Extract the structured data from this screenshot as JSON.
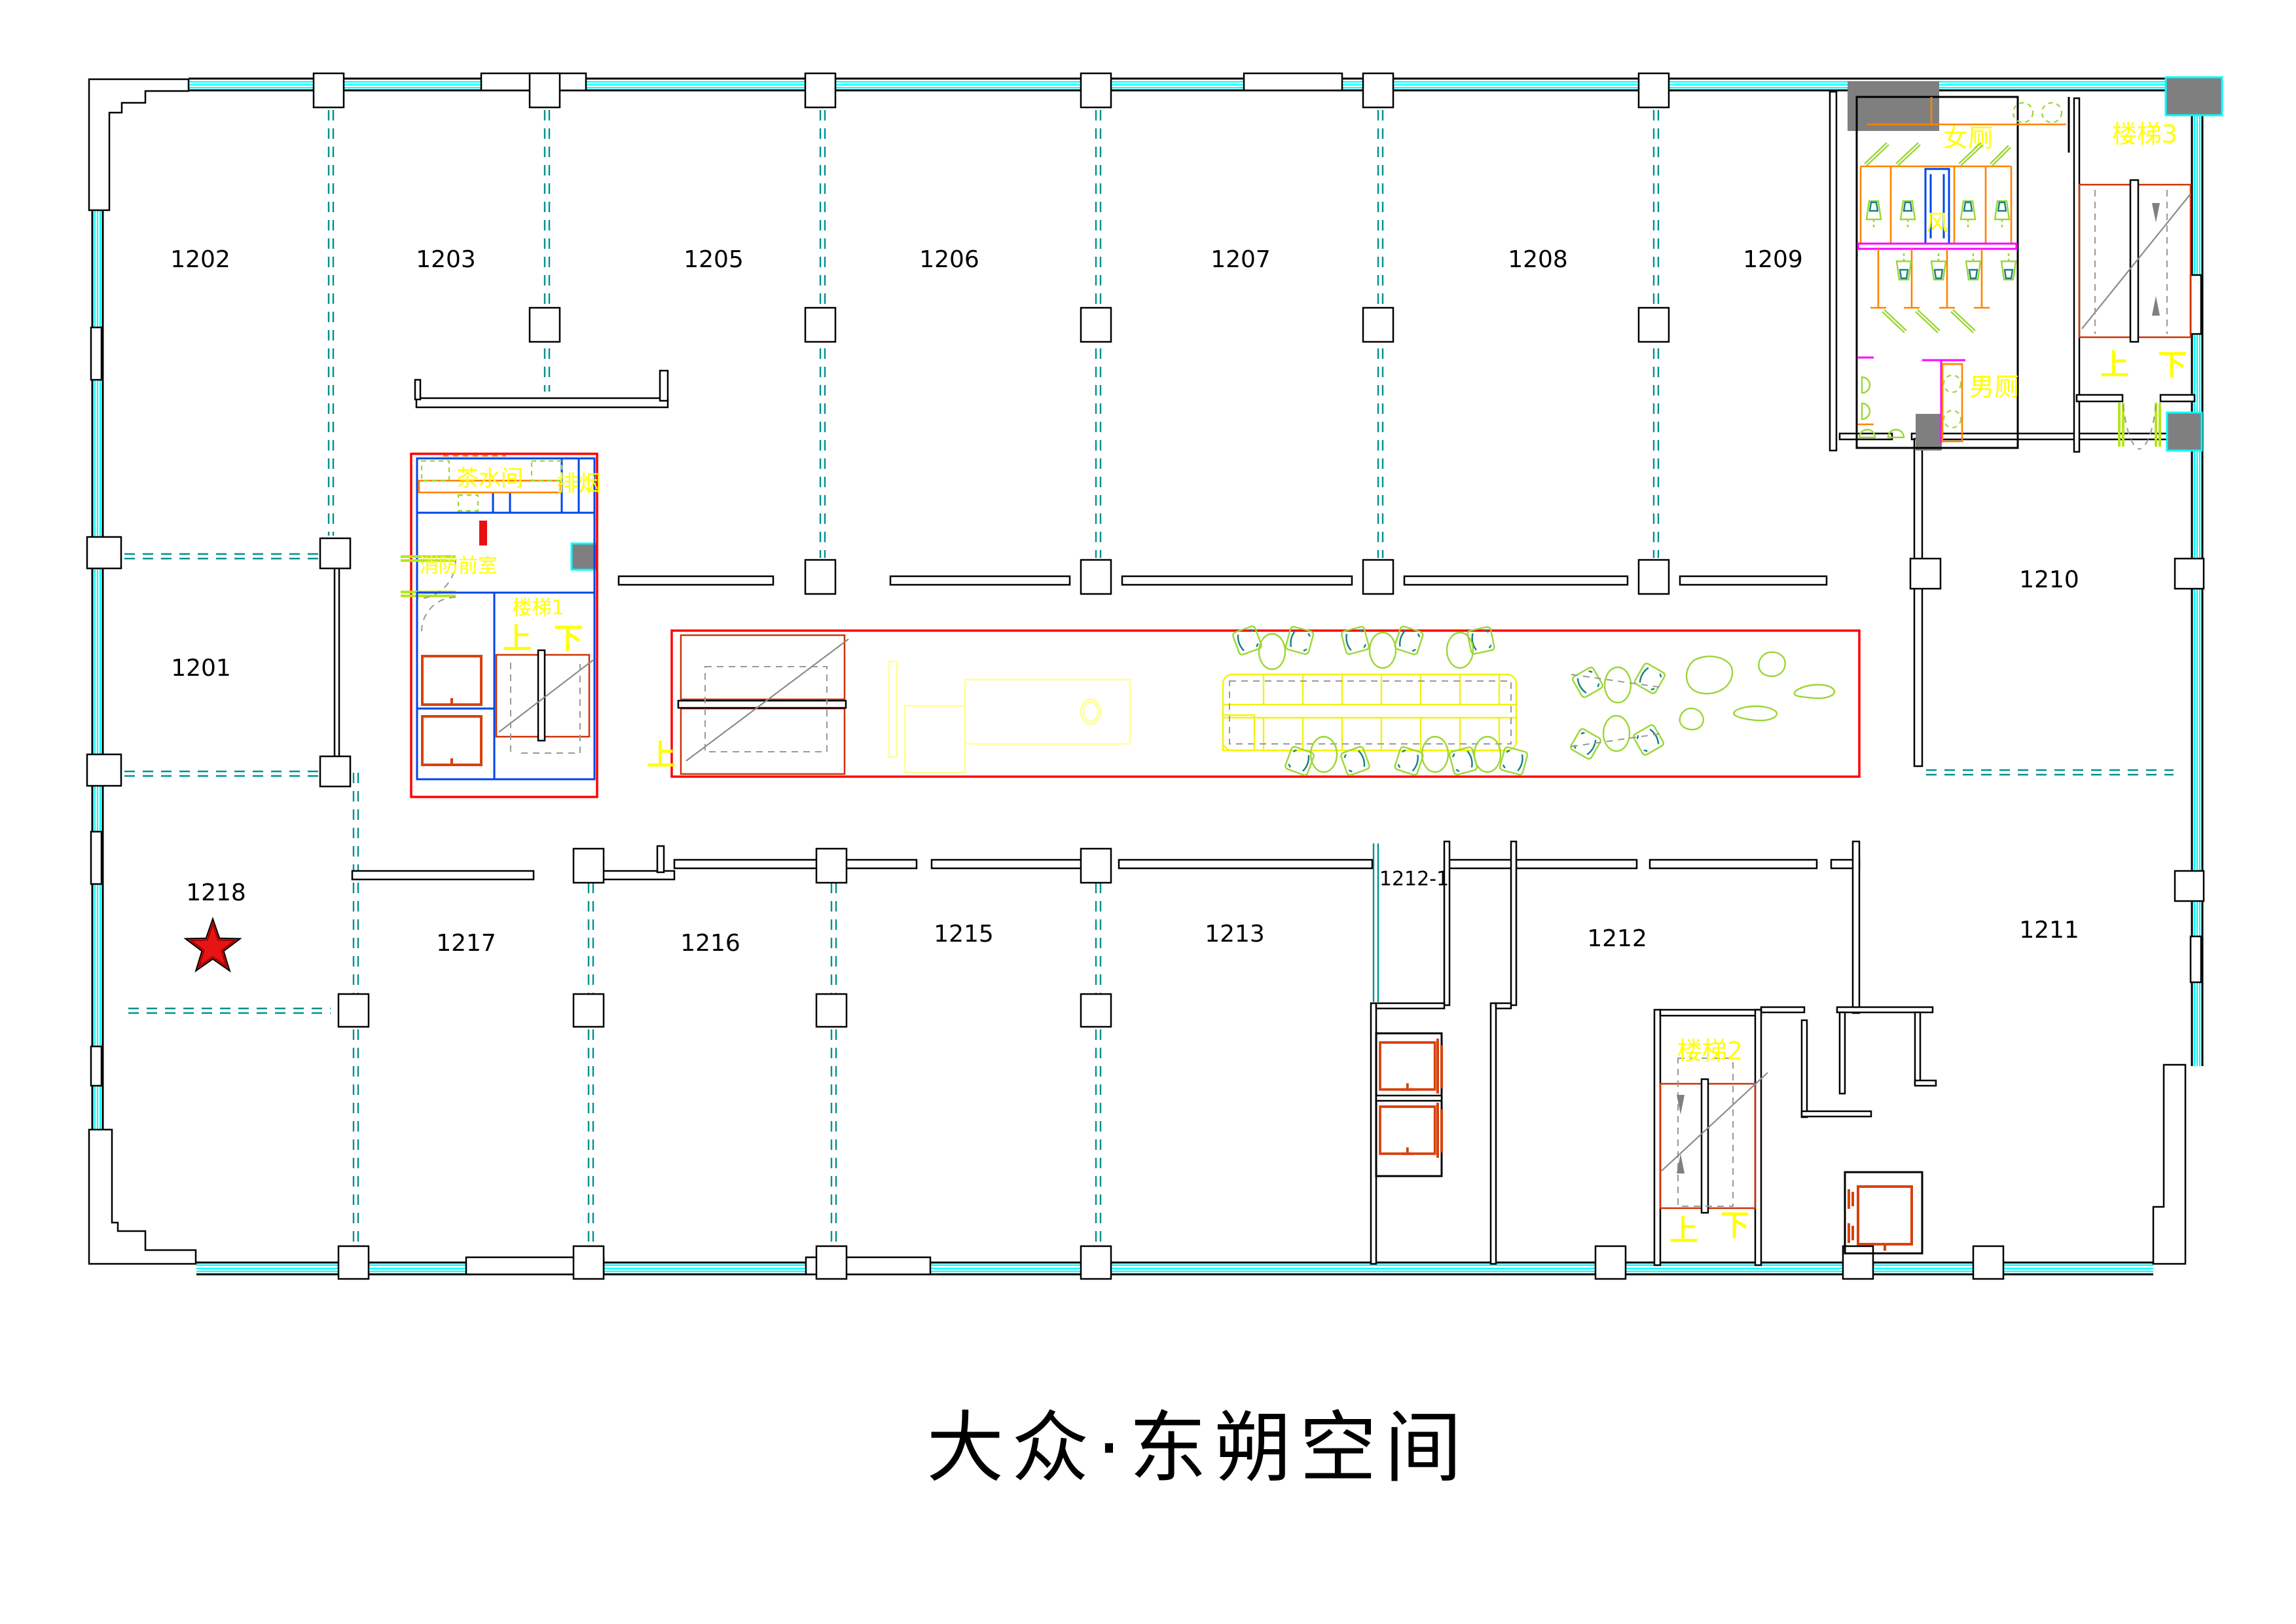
{
  "title": "大众·东朔空间",
  "plan": {
    "rooms": {
      "1201": "1201",
      "1202": "1202",
      "1203": "1203",
      "1205": "1205",
      "1206": "1206",
      "1207": "1207",
      "1208": "1208",
      "1209": "1209",
      "1210": "1210",
      "1211": "1211",
      "1212": "1212",
      "1212_1": "1212-1",
      "1213": "1213",
      "1215": "1215",
      "1216": "1216",
      "1217": "1217",
      "1218": "1218"
    },
    "core": {
      "tea_room": "茶水间",
      "smoke_exhaust": "排烟",
      "fire_anteroom": "消防前室",
      "stair1": "楼梯1",
      "up": "上",
      "down": "下"
    },
    "toilets": {
      "women": "女厕",
      "men": "男厕",
      "vent": "风"
    },
    "stairs": {
      "stair2": "楼梯2",
      "stair3": "楼梯3",
      "up": "上",
      "down": "下"
    },
    "marker": {
      "type": "red-star",
      "room": "1218"
    }
  },
  "colors": {
    "window_cyan": "#00ffff",
    "partition_teal": "#009090",
    "core_red": "#ff0000",
    "inner_blue": "#0046e8",
    "stair_red": "#cc3305",
    "elevator_orange": "#d7420f",
    "stall_orange": "#ff8200",
    "fixture_green": "#9cd636",
    "furniture_yellow": "#f2f20c",
    "label_yellow": "#ffff00",
    "magenta": "#ff00ff",
    "gray_block": "#7f7f7f",
    "star_red": "#e81313"
  }
}
